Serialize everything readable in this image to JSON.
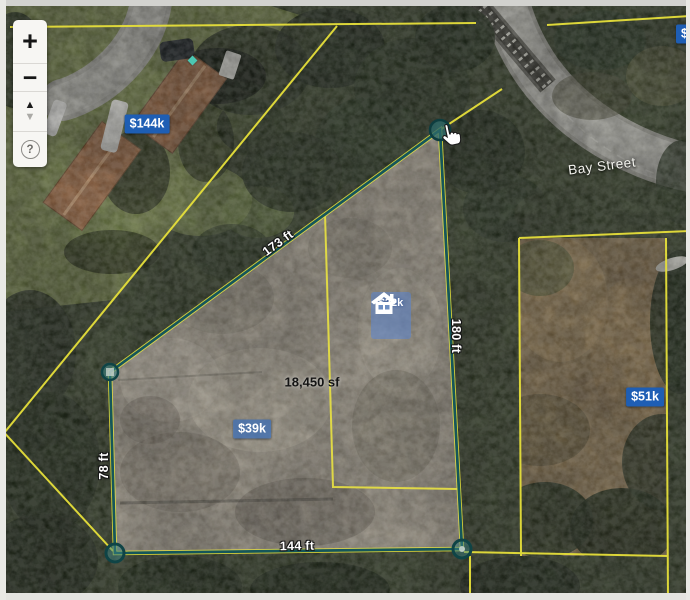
{
  "zoom_controls": {
    "zoom_in": "+",
    "zoom_out": "−",
    "pan_up": "▲",
    "pan_down": "▼",
    "help": "?"
  },
  "street": {
    "name": "Bay Street"
  },
  "selected_parcel": {
    "area": "18,450 sf",
    "price": "$22k",
    "dim_top": "173 ft",
    "dim_right": "180 ft",
    "dim_bottom": "144 ft",
    "dim_left": "78 ft"
  },
  "badges": {
    "northwest": "$144k",
    "center": "$39k",
    "east": "$51k",
    "northeast_partial": "$"
  },
  "colors": {
    "badge_blue": "#1e5eb4",
    "boundary_yellow": "#e6df3a",
    "selection_teal": "#15565a"
  }
}
